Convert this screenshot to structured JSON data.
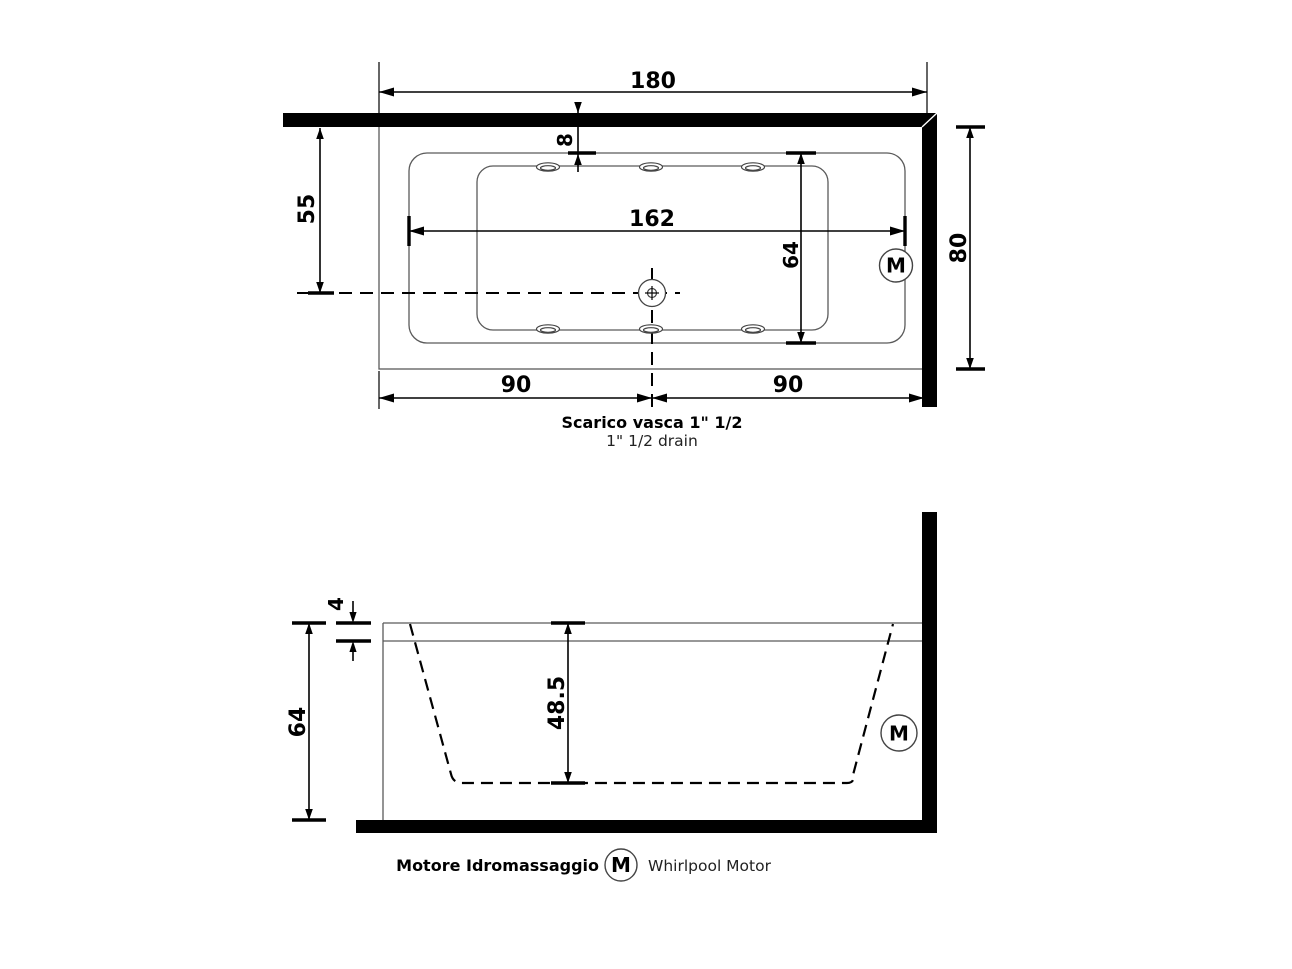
{
  "plan": {
    "dims": {
      "total_width": "180",
      "jet_offset": "8",
      "wall_to_center": "55",
      "basin_length": "162",
      "basin_width": "64",
      "total_depth": "80",
      "drain_left": "90",
      "drain_right": "90"
    },
    "motor": "M",
    "drain_title": "Scarico vasca 1\" 1/2",
    "drain_subtitle": "1\" 1/2  drain"
  },
  "side": {
    "dims": {
      "rim_thickness": "4",
      "total_height": "64",
      "inner_depth": "48.5"
    },
    "motor": "M"
  },
  "legend": {
    "title_it": "Motore Idromassaggio",
    "symbol": "M",
    "title_en": "Whirlpool Motor"
  },
  "colors": {
    "line": "#000000",
    "thin_outline": "#5a5a5a",
    "background": "#ffffff"
  }
}
